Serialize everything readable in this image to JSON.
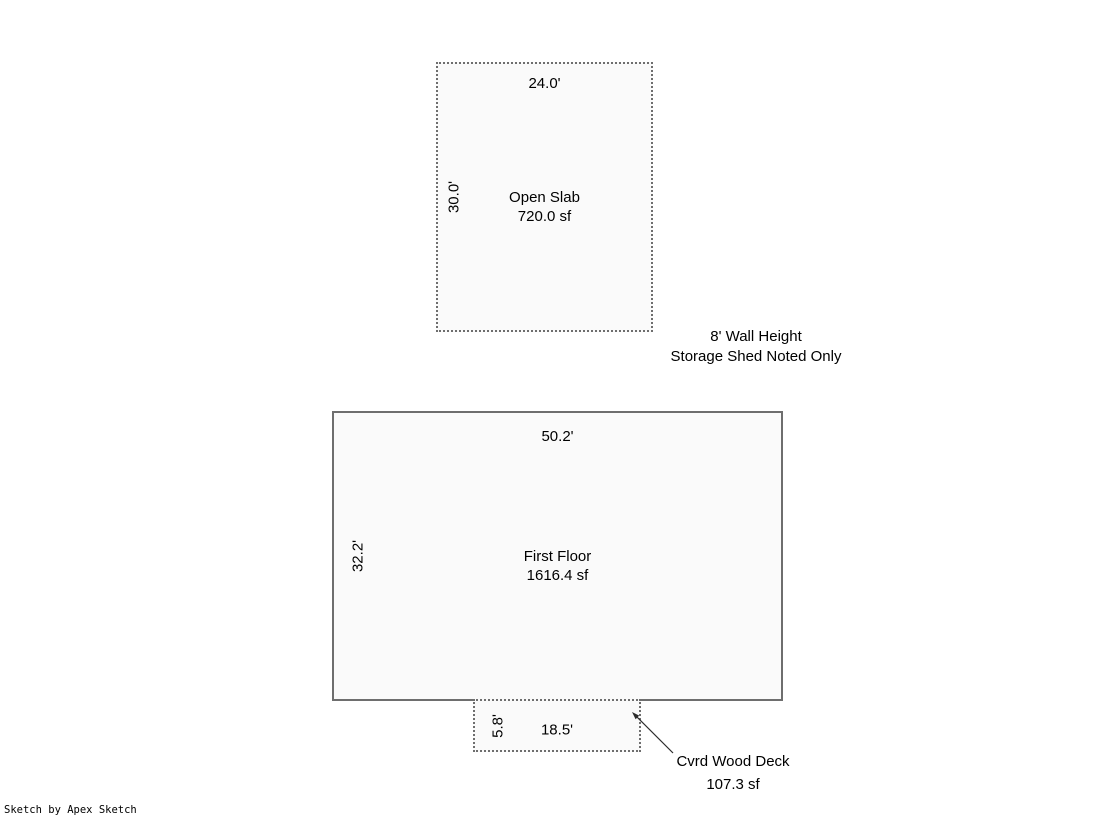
{
  "colors": {
    "background": "#ffffff",
    "shape_fill": "#fafafa",
    "border_solid": "#6e6e6e",
    "border_dashed": "#6e6e6e",
    "text": "#000000",
    "arrow": "#2b2b2b"
  },
  "icons": {
    "deck_callout_arrow": "thin-diagonal-arrow-pointing-up-left-to-deck-corner"
  },
  "sketch": {
    "open_slab": {
      "name": "Open Slab",
      "area": "720.0 sf",
      "top_dim": "24.0'",
      "left_dim": "30.0'"
    },
    "shed_note": {
      "line1": "8' Wall Height",
      "line2": "Storage Shed Noted Only"
    },
    "first_floor": {
      "name": "First Floor",
      "area": "1616.4 sf",
      "top_dim": "50.2'",
      "left_dim": "32.2'"
    },
    "deck": {
      "top_dim": "18.5'",
      "left_dim": "5.8'",
      "callout_name": "Cvrd Wood Deck",
      "callout_area": "107.3 sf"
    },
    "credit": "Sketch by Apex Sketch"
  }
}
